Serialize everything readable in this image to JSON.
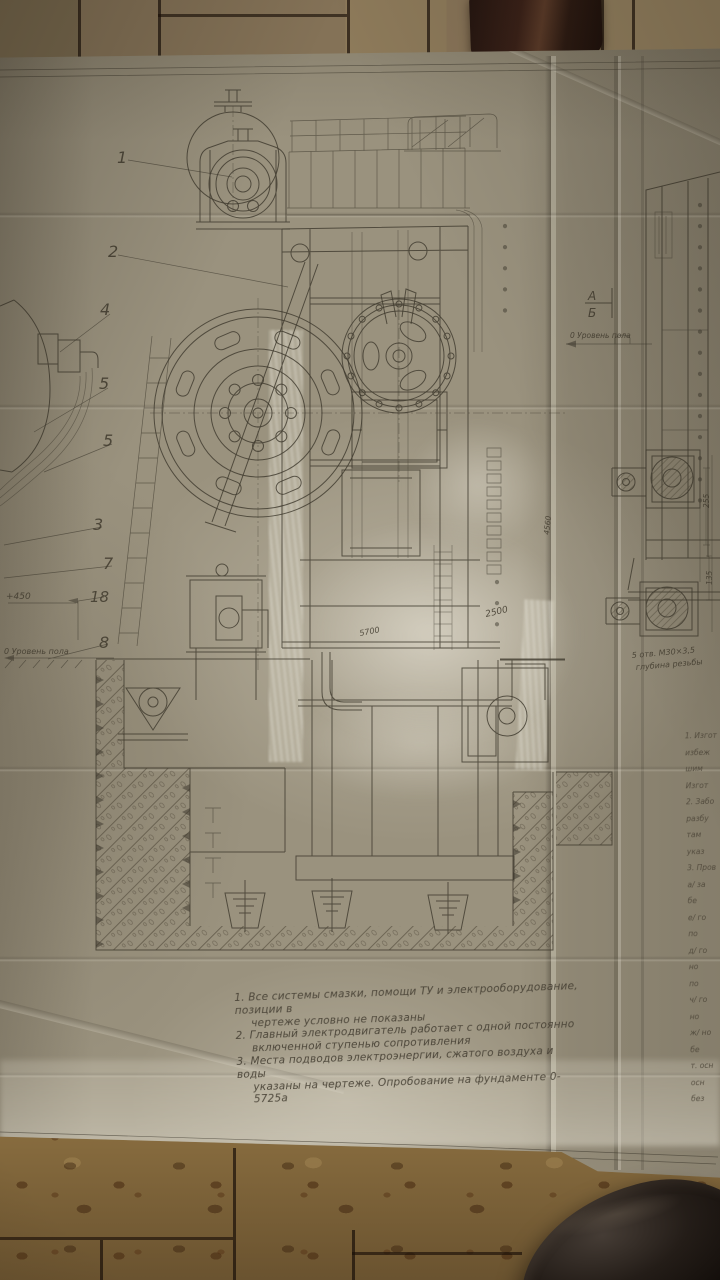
{
  "drawing": {
    "callouts": {
      "c1": "1",
      "c2": "2",
      "c4": "4",
      "c5a": "5",
      "c5b": "5",
      "c3": "3",
      "c7": "7",
      "c18": "18",
      "c8": "8"
    },
    "labels": {
      "elevation": "+450",
      "floor_level_left": "0 Уровень пола",
      "floor_level_right": "0 Уровень пола",
      "section_a": "А",
      "section_b": "Б",
      "holes_line1": "5 отв. М30×3,5",
      "holes_line2": "глубина резьбы"
    },
    "dimensions": {
      "d1": "2500",
      "d2": "5700",
      "d3": "4560",
      "d4": "255",
      "d5": "135"
    },
    "notes_lines": [
      "1. Все системы смазки, помощи ТУ и электрооборудование, позиции в",
      "чертеже условно не показаны",
      "2. Главный электродвигатель работает с одной постоянно",
      "включенной ступенью сопротивления",
      "3. Места подводов электроэнергии, сжатого воздуха и воды",
      "указаны на чертеже. Опробование на фундаменте 0-5725а"
    ],
    "margin_notes_lines": [
      "1. Изгот",
      "избеж",
      "шим",
      "Изгот",
      "2. Забо",
      "разбу",
      "там",
      "указ",
      "3. Пров",
      "а/ за",
      "бе",
      "е/ го",
      "по",
      "д/ го",
      "но",
      "по",
      "ч/ го",
      "но",
      "ж/ но",
      "бе",
      "т. осн",
      "осн",
      "без"
    ]
  },
  "colors": {
    "paper": "#9a927e",
    "ink": "#3e392d",
    "floor_top": "#857254",
    "floor_bottom": "#9a7c49",
    "grout": "#1a1008",
    "shoe": "#171210",
    "tape_glare": "#e2ddce"
  }
}
